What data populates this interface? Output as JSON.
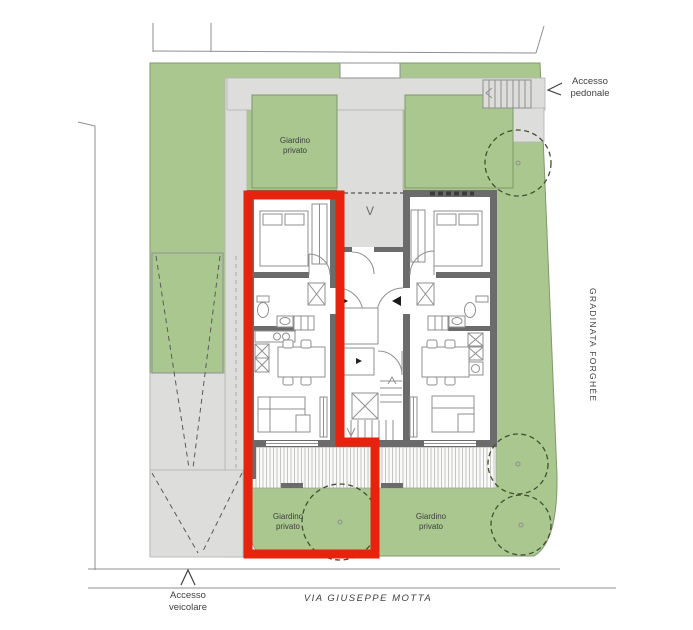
{
  "plan": {
    "kind": "residential site plan"
  },
  "labels": {
    "accesso_pedonale": "Accesso pedonale",
    "accesso_veicolare": "Accesso veicolare",
    "giardino_privato": "Giardino privato",
    "gradinata_forghee": "GRADINATA FORGHÉE",
    "via_giuseppe_motta": "VIA GIUSEPPE MOTTA",
    "vestibolo": "V"
  },
  "icons": {
    "pedestrian_access_arrow": "<",
    "vehicle_access_arrow": "^"
  },
  "colors": {
    "garden_green": "#a9c78f",
    "garden_outline": "#7f996a",
    "path_gray": "#dddddb",
    "wall_gray": "#6b6b6b",
    "highlight_red": "#e8230d",
    "line_gray": "#8f8f8f",
    "text_color": "#3f3f3f",
    "tree_outline": "#42502f"
  }
}
